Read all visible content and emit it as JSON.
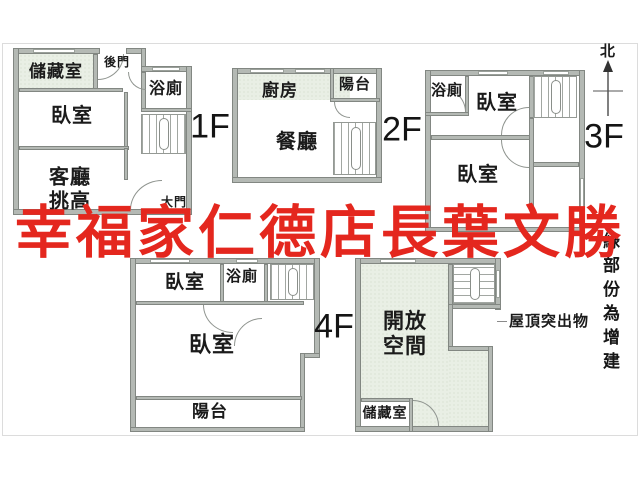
{
  "watermark": {
    "text": "幸福家仁德店長葉文勝",
    "color": "#e4271e"
  },
  "annotations": {
    "north": "北",
    "roof_protrusion": "屋頂突出物",
    "green_note": "綠部份為增建"
  },
  "floor_1f": {
    "tag": "1F",
    "storage": "儲藏室",
    "back_door": "後門",
    "bedroom": "臥室",
    "bath": "浴廁",
    "living": "客廳\n挑高",
    "main_door": "大門"
  },
  "floor_2f": {
    "tag": "2F",
    "kitchen": "廚房",
    "balcony": "陽台",
    "dining": "餐廳"
  },
  "floor_3f": {
    "tag": "3F",
    "bath": "浴廁",
    "bedroom_upper": "臥室",
    "bedroom_lower": "臥室"
  },
  "floor_4f": {
    "tag": "4F",
    "bedroom_upper": "臥室",
    "bath": "浴廁",
    "bedroom_main": "臥室",
    "balcony": "陽台"
  },
  "roof": {
    "open_space": "開放\n空間",
    "storage": "儲藏室"
  },
  "colors": {
    "wall": "#b4b9b4",
    "addition_green": "#e9efe5",
    "watermark_red": "#e4271e"
  }
}
